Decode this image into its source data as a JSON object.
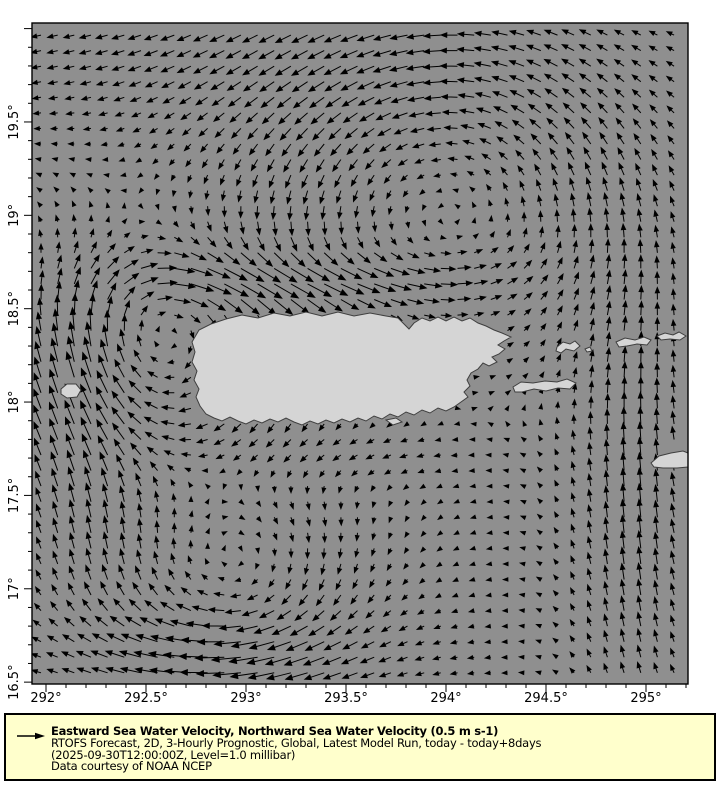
{
  "figure": {
    "width": 720,
    "height": 800,
    "background": "#ffffff"
  },
  "map": {
    "frame": {
      "left": 32,
      "top": 23,
      "right": 688,
      "bottom": 684
    },
    "lon_min": 291.93,
    "lon_max": 295.21,
    "lat_min": 16.49,
    "lat_max": 20.03,
    "sea_color": "#8f8f8f",
    "land_color": "#d5d5d5",
    "coast_color": "#3f3f3f",
    "frame_color": "#000000",
    "arrow_color": "#000000"
  },
  "axes": {
    "tick_color": "#000000",
    "label_font_px": 13,
    "minor_step_deg": 0.1,
    "lon_major": [
      {
        "value": 292.0,
        "label": "292°"
      },
      {
        "value": 292.5,
        "label": "292.5°"
      },
      {
        "value": 293.0,
        "label": "293°"
      },
      {
        "value": 293.5,
        "label": "293.5°"
      },
      {
        "value": 294.0,
        "label": "294°"
      },
      {
        "value": 294.5,
        "label": "294.5°"
      },
      {
        "value": 295.0,
        "label": "295°"
      }
    ],
    "lat_major": [
      {
        "value": 19.5,
        "label": "19.5°"
      },
      {
        "value": 19.0,
        "label": "19°"
      },
      {
        "value": 18.5,
        "label": "18.5°"
      },
      {
        "value": 18.0,
        "label": "18°"
      },
      {
        "value": 17.5,
        "label": "17.5°"
      },
      {
        "value": 17.0,
        "label": "17°"
      },
      {
        "value": 16.5,
        "label": "16.5°"
      }
    ]
  },
  "islands": [
    {
      "name": "puerto-rico",
      "points": [
        [
          192,
          342
        ],
        [
          199,
          330
        ],
        [
          211,
          324
        ],
        [
          226,
          319
        ],
        [
          242,
          315
        ],
        [
          258,
          318
        ],
        [
          274,
          313
        ],
        [
          290,
          316
        ],
        [
          306,
          312
        ],
        [
          322,
          316
        ],
        [
          338,
          312
        ],
        [
          354,
          316
        ],
        [
          370,
          313
        ],
        [
          386,
          316
        ],
        [
          398,
          318
        ],
        [
          404,
          324
        ],
        [
          409,
          329
        ],
        [
          414,
          323
        ],
        [
          422,
          318
        ],
        [
          430,
          321
        ],
        [
          438,
          317
        ],
        [
          446,
          321
        ],
        [
          454,
          317
        ],
        [
          462,
          321
        ],
        [
          470,
          318
        ],
        [
          478,
          323
        ],
        [
          486,
          326
        ],
        [
          494,
          330
        ],
        [
          502,
          333
        ],
        [
          511,
          337
        ],
        [
          504,
          341
        ],
        [
          498,
          345
        ],
        [
          505,
          349
        ],
        [
          499,
          354
        ],
        [
          492,
          357
        ],
        [
          497,
          362
        ],
        [
          489,
          366
        ],
        [
          483,
          363
        ],
        [
          478,
          369
        ],
        [
          471,
          373
        ],
        [
          467,
          380
        ],
        [
          470,
          386
        ],
        [
          464,
          392
        ],
        [
          468,
          397
        ],
        [
          461,
          402
        ],
        [
          454,
          407
        ],
        [
          446,
          411
        ],
        [
          438,
          408
        ],
        [
          430,
          413
        ],
        [
          422,
          410
        ],
        [
          414,
          415
        ],
        [
          406,
          412
        ],
        [
          398,
          417
        ],
        [
          390,
          414
        ],
        [
          382,
          419
        ],
        [
          374,
          416
        ],
        [
          366,
          421
        ],
        [
          358,
          418
        ],
        [
          350,
          422
        ],
        [
          342,
          419
        ],
        [
          334,
          423
        ],
        [
          326,
          420
        ],
        [
          318,
          424
        ],
        [
          310,
          421
        ],
        [
          302,
          425
        ],
        [
          294,
          422
        ],
        [
          286,
          418
        ],
        [
          278,
          422
        ],
        [
          270,
          419
        ],
        [
          262,
          423
        ],
        [
          254,
          420
        ],
        [
          246,
          424
        ],
        [
          238,
          421
        ],
        [
          230,
          417
        ],
        [
          222,
          421
        ],
        [
          214,
          418
        ],
        [
          206,
          414
        ],
        [
          200,
          406
        ],
        [
          196,
          397
        ],
        [
          199,
          389
        ],
        [
          194,
          380
        ],
        [
          197,
          371
        ],
        [
          192,
          362
        ],
        [
          195,
          352
        ]
      ]
    },
    {
      "name": "mona-island",
      "points": [
        [
          61,
          389
        ],
        [
          67,
          384
        ],
        [
          76,
          384
        ],
        [
          81,
          390
        ],
        [
          77,
          397
        ],
        [
          67,
          398
        ],
        [
          61,
          394
        ]
      ]
    },
    {
      "name": "vieques",
      "points": [
        [
          513,
          387
        ],
        [
          521,
          382
        ],
        [
          533,
          383
        ],
        [
          545,
          381
        ],
        [
          557,
          382
        ],
        [
          567,
          379
        ],
        [
          576,
          383
        ],
        [
          570,
          389
        ],
        [
          558,
          388
        ],
        [
          546,
          391
        ],
        [
          534,
          389
        ],
        [
          522,
          392
        ],
        [
          515,
          392
        ]
      ]
    },
    {
      "name": "culebra",
      "points": [
        [
          557,
          347
        ],
        [
          563,
          342
        ],
        [
          570,
          344
        ],
        [
          575,
          341
        ],
        [
          580,
          346
        ],
        [
          574,
          351
        ],
        [
          566,
          349
        ],
        [
          561,
          353
        ],
        [
          556,
          351
        ]
      ]
    },
    {
      "name": "culebrita",
      "points": [
        [
          585,
          349
        ],
        [
          590,
          347
        ],
        [
          592,
          351
        ],
        [
          587,
          352
        ]
      ]
    },
    {
      "name": "st-thomas",
      "points": [
        [
          616,
          342
        ],
        [
          625,
          338
        ],
        [
          635,
          340
        ],
        [
          644,
          337
        ],
        [
          651,
          340
        ],
        [
          647,
          345
        ],
        [
          637,
          344
        ],
        [
          627,
          346
        ],
        [
          619,
          347
        ]
      ]
    },
    {
      "name": "tortola-chain",
      "points": [
        [
          657,
          336
        ],
        [
          665,
          333
        ],
        [
          673,
          335
        ],
        [
          679,
          332
        ],
        [
          686,
          336
        ],
        [
          680,
          340
        ],
        [
          670,
          339
        ],
        [
          661,
          340
        ]
      ]
    },
    {
      "name": "st-croix",
      "points": [
        [
          651,
          463
        ],
        [
          659,
          456
        ],
        [
          671,
          453
        ],
        [
          683,
          451
        ],
        [
          688,
          453
        ],
        [
          688,
          467
        ],
        [
          677,
          468
        ],
        [
          663,
          468
        ],
        [
          654,
          467
        ]
      ]
    },
    {
      "name": "caja-de-muertos",
      "points": [
        [
          386,
          420
        ],
        [
          396,
          418
        ],
        [
          402,
          422
        ],
        [
          393,
          425
        ]
      ]
    }
  ],
  "flow": {
    "grid": {
      "lon_start": 291.975,
      "lat_start": 16.55,
      "step_deg": 0.0833,
      "cols": 39,
      "rows": 42
    },
    "scale_px_per_ms": 45,
    "reference_speed_ms": 0.5,
    "min_arrow_px": 2.5,
    "features": [
      {
        "type": "vortex",
        "cx": 292.6,
        "cy": 18.3,
        "r": 0.55,
        "s": -0.55,
        "note": "clockwise meander northwest of Puerto Rico"
      },
      {
        "type": "vortex",
        "cx": 294.0,
        "cy": 19.15,
        "r": 0.95,
        "s": 0.6,
        "note": "counterclockwise gyre northeast"
      },
      {
        "type": "vortex",
        "cx": 292.95,
        "cy": 17.05,
        "r": 0.6,
        "s": -0.5,
        "note": "clockwise eddy southwest"
      },
      {
        "type": "jet",
        "cx": 292.15,
        "cy": 17.9,
        "rx": 0.38,
        "ry": 1.0,
        "u": 0.0,
        "v": 0.38,
        "note": "Mona Passage northward jet"
      },
      {
        "type": "jet",
        "cx": 293.2,
        "cy": 18.66,
        "rx": 0.9,
        "ry": 0.18,
        "u": 0.45,
        "v": 0.02,
        "note": "eastward jet north of Puerto Rico"
      },
      {
        "type": "jet",
        "cx": 294.95,
        "cy": 17.4,
        "rx": 0.35,
        "ry": 1.2,
        "u": 0.05,
        "v": 0.4,
        "note": "northward jet east of Vieques"
      },
      {
        "type": "jet",
        "cx": 292.9,
        "cy": 16.62,
        "rx": 0.8,
        "ry": 0.25,
        "u": -0.33,
        "v": -0.04,
        "note": "westward flow along south edge"
      },
      {
        "type": "jet",
        "cx": 293.5,
        "cy": 17.75,
        "rx": 0.8,
        "ry": 0.2,
        "u": -0.2,
        "v": 0.0,
        "note": "westward flow south of island"
      },
      {
        "type": "jet",
        "cx": 292.6,
        "cy": 19.9,
        "rx": 1.0,
        "ry": 0.45,
        "u": -0.16,
        "v": -0.05,
        "note": "weak westward band along top"
      },
      {
        "type": "drift",
        "u": -0.1,
        "v": -0.01,
        "note": "background drift"
      }
    ]
  },
  "legend": {
    "bg": "#ffffcc",
    "border_color": "#000000",
    "box": {
      "left": 4,
      "top": 713,
      "width": 712,
      "height": 68
    },
    "title": "Eastward Sea Water Velocity, Northward Sea Water Velocity (0.5 m s-1)",
    "line2": "RTOFS Forecast, 2D, 3-Hourly Prognostic, Global, Latest Model Run, today - today+8days",
    "line3": "(2025-09-30T12:00:00Z, Level=1.0 millibar)",
    "line4": "Data courtesy of NOAA NCEP",
    "reference_arrow_icon": "right-arrow-icon"
  }
}
